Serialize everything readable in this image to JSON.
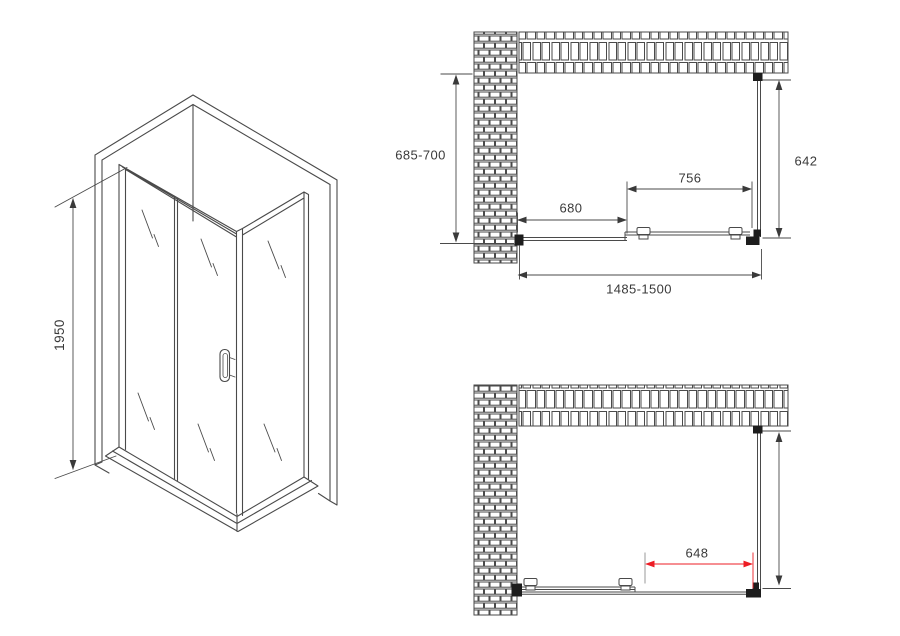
{
  "colors": {
    "line": "#4a4a4a",
    "text": "#3a3a3a",
    "accent_red": "#ed1c24",
    "connector": "#1d1d1d",
    "background": "#ffffff"
  },
  "isometric_view": {
    "height_label": "1950"
  },
  "top_plan_view": {
    "depth_label": "685-700",
    "fixed_panel_label": "680",
    "door_label": "756",
    "side_panel_label": "642",
    "overall_width_label": "1485-1500"
  },
  "bottom_plan_view": {
    "door_opening_label": "648"
  }
}
